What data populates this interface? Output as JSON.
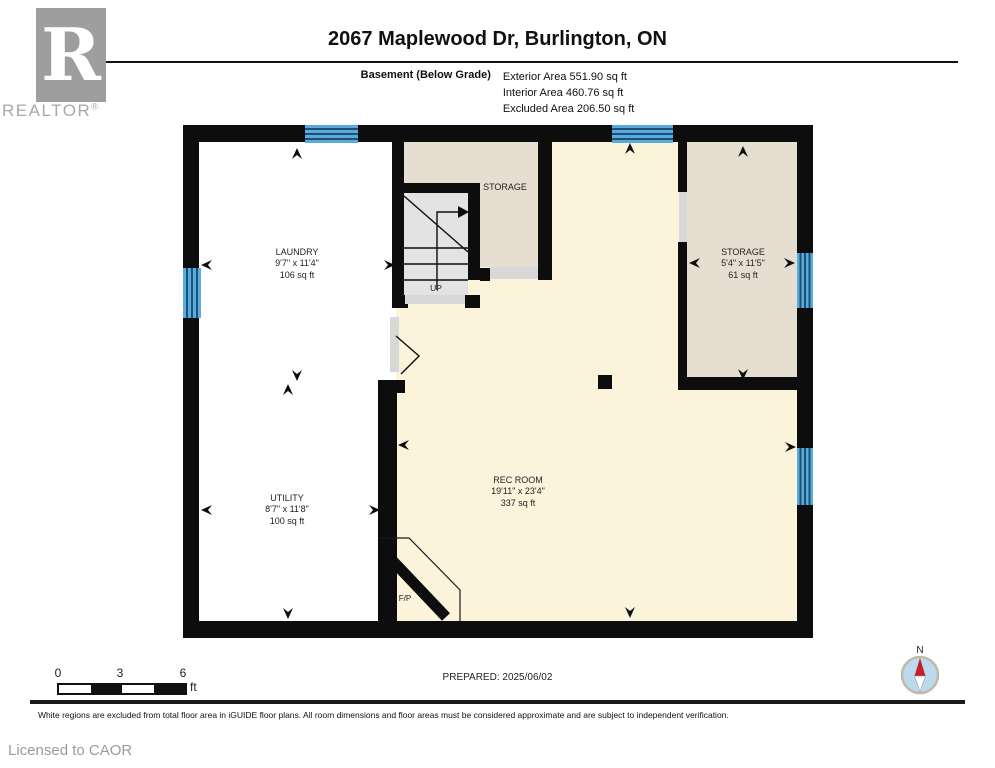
{
  "branding": {
    "logo_letter": "R",
    "logo_word": "REALTOR",
    "registered_mark": "®",
    "licensed_to": "Licensed to CAOR"
  },
  "header": {
    "title": "2067 Maplewood Dr, Burlington, ON",
    "floor_label": "Basement (Below Grade)",
    "area_lines": [
      "Exterior Area 551.90 sq ft",
      "Interior Area 460.76 sq ft",
      "Excluded Area 206.50 sq ft"
    ]
  },
  "floorplan": {
    "rooms": [
      {
        "name": "LAUNDRY",
        "dims": "9'7\" x 11'4\"",
        "area": "106 sq ft"
      },
      {
        "name": "STORAGE"
      },
      {
        "name": "STORAGE",
        "dims": "5'4\" x 11'5\"",
        "area": "61 sq ft"
      },
      {
        "name": "UTILITY",
        "dims": "8'7\" x 11'8\"",
        "area": "100 sq ft"
      },
      {
        "name": "REC ROOM",
        "dims": "19'11\" x 23'4\"",
        "area": "337 sq ft"
      }
    ],
    "stair_label": "UP",
    "fireplace_label": "F/P",
    "colors": {
      "wall": "#0d0d0d",
      "excluded_area": "#ffffff",
      "interior_area": "#fbf3da",
      "storage_area": "#e6dfd1",
      "stairs": "#e3e3e3",
      "window": "#5aabdb",
      "window_stripe": "#1d5075",
      "opening": "#d8d8d8"
    }
  },
  "footer": {
    "scale": {
      "ticks": [
        "0",
        "3",
        "6"
      ],
      "unit": "ft"
    },
    "prepared": "PREPARED: 2025/06/02",
    "compass_label": "N",
    "disclaimer": "White regions are excluded from total floor area in iGUIDE floor plans. All room dimensions and floor areas must be considered approximate and are subject to independent verification."
  }
}
